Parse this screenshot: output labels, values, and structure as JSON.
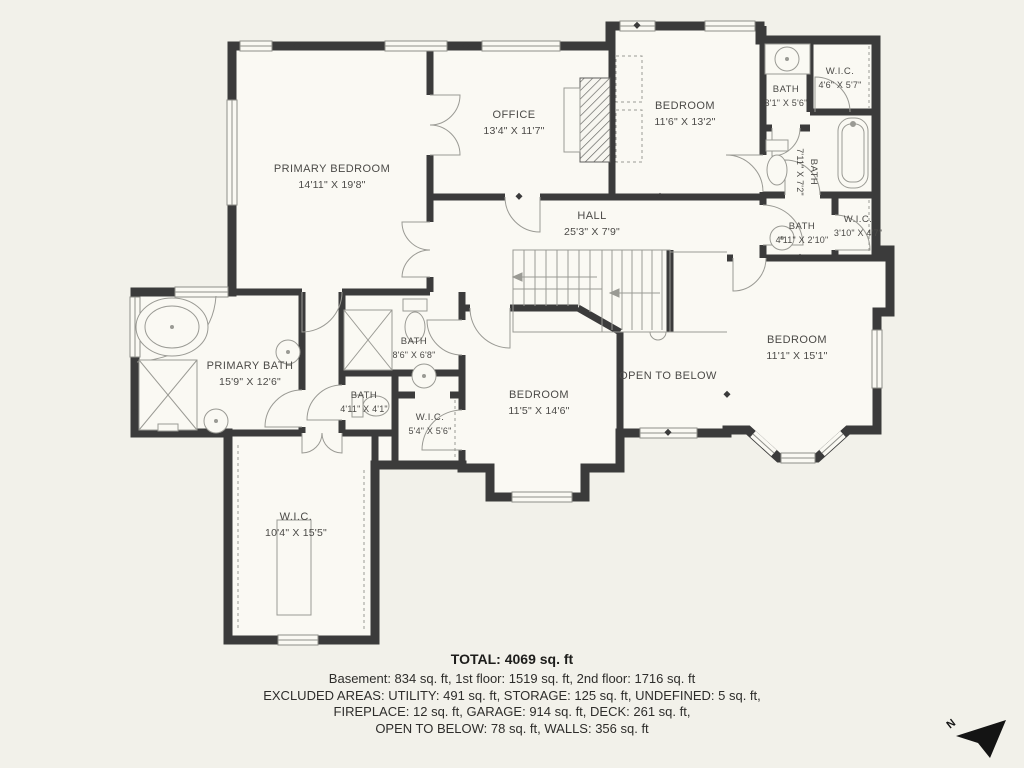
{
  "floor_plan": {
    "rooms": {
      "primary_bedroom": {
        "name": "PRIMARY BEDROOM",
        "dims": "14'11\" X 19'8\""
      },
      "office": {
        "name": "OFFICE",
        "dims": "13'4\" X 11'7\""
      },
      "bedroom_top": {
        "name": "BEDROOM",
        "dims": "11'6\" X 13'2\""
      },
      "bath_top": {
        "name": "BATH",
        "dims": "3'1\" X 5'6\""
      },
      "wic_top": {
        "name": "W.I.C.",
        "dims": "4'6\" X 5'7\""
      },
      "bath_mid_right": {
        "name": "BATH",
        "dims": "7'11\" X 7'2\""
      },
      "hall": {
        "name": "HALL",
        "dims": "25'3\" X 7'9\""
      },
      "bath_small": {
        "name": "BATH",
        "dims": "4'11\" X 2'10\""
      },
      "wic_small": {
        "name": "W.I.C.",
        "dims": "3'10\" X 4'7\""
      },
      "primary_bath": {
        "name": "PRIMARY BATH",
        "dims": "15'9\" X 12'6\""
      },
      "bath_86": {
        "name": "BATH",
        "dims": "8'6\" X 6'8\""
      },
      "bath_411": {
        "name": "BATH",
        "dims": "4'11\" X 4'1\""
      },
      "wic_54": {
        "name": "W.I.C.",
        "dims": "5'4\" X 5'6\""
      },
      "bedroom_mid": {
        "name": "BEDROOM",
        "dims": "11'5\" X 14'6\""
      },
      "open_below": {
        "name": "OPEN TO BELOW"
      },
      "bedroom_right": {
        "name": "BEDROOM",
        "dims": "11'1\" X 15'1\""
      },
      "wic_large": {
        "name": "W.I.C.",
        "dims": "10'4\" X 15'5\""
      }
    },
    "summary": {
      "total": "TOTAL: 4069 sq. ft",
      "line1": "Basement: 834 sq. ft, 1st floor: 1519 sq. ft, 2nd floor: 1716 sq. ft",
      "line2": "EXCLUDED AREAS: UTILITY: 491 sq. ft, STORAGE: 125 sq. ft, UNDEFINED: 5 sq. ft,",
      "line3": "FIREPLACE: 12 sq. ft, GARAGE: 914 sq. ft, DECK: 261 sq. ft,",
      "line4": "OPEN TO BELOW: 78 sq. ft, WALLS: 356 sq. ft"
    },
    "compass": {
      "label": "N"
    },
    "colors": {
      "background": "#f2f1ea",
      "wall": "#3b3b3b",
      "floor": "#faf9f3",
      "label_text": "#4b4a47"
    }
  }
}
